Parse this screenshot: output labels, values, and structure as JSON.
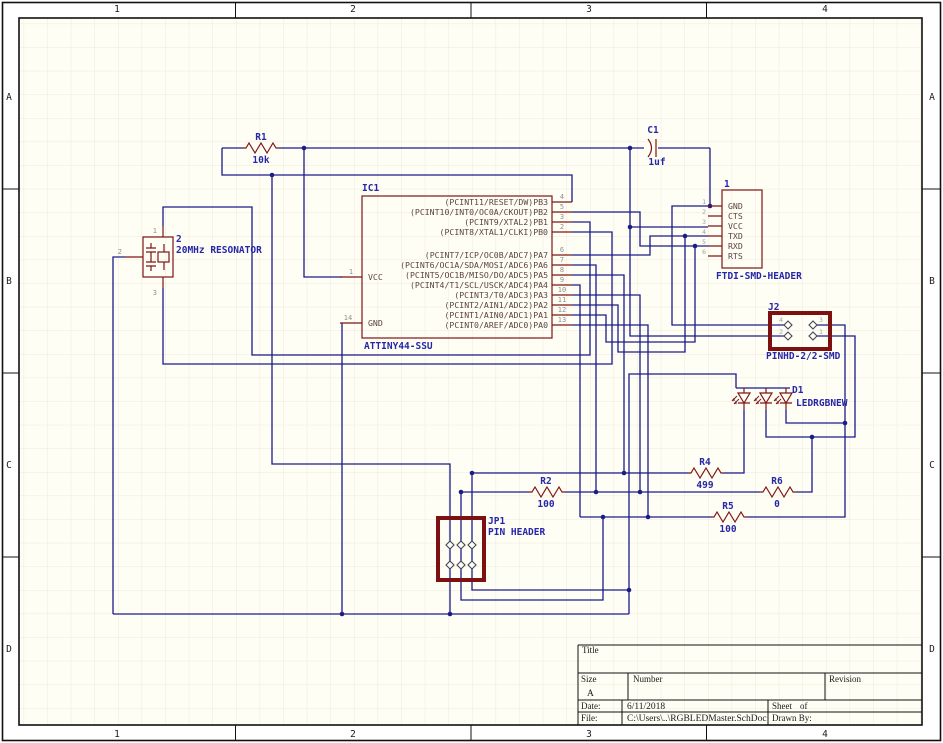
{
  "sheet": {
    "zone_columns": [
      "1",
      "2",
      "3",
      "4"
    ],
    "zone_rows": [
      "A",
      "B",
      "C",
      "D"
    ]
  },
  "title_block": {
    "title_label": "Title",
    "size_label": "Size",
    "size_value": "A",
    "number_label": "Number",
    "revision_label": "Revision",
    "date_label": "Date:",
    "date_value": "6/11/2018",
    "file_label": "File:",
    "file_value": "C:\\Users\\..\\RGBLEDMaster.SchDoc",
    "sheet_label": "Sheet",
    "sheet_of": "of",
    "drawn_by_label": "Drawn By:"
  },
  "components": {
    "ic1": {
      "designator": "IC1",
      "part": "ATTINY44-SSU",
      "left_pins": [
        {
          "num": "1",
          "name": "VCC"
        },
        {
          "num": "14",
          "name": "GND"
        }
      ],
      "right_pins": [
        {
          "num": "4",
          "name": "(PCINT11/RESET/DW)PB3"
        },
        {
          "num": "5",
          "name": "(PCINT10/INT0/OC0A/CKOUT)PB2"
        },
        {
          "num": "3",
          "name": "(PCINT9/XTAL2)PB1"
        },
        {
          "num": "2",
          "name": "(PCINT8/XTAL1/CLKI)PB0"
        },
        {
          "num": "6",
          "name": "(PCINT7/ICP/OC0B/ADC7)PA7"
        },
        {
          "num": "7",
          "name": "(PCINT6/OC1A/SDA/MOSI/ADC6)PA6"
        },
        {
          "num": "8",
          "name": "(PCINT5/OC1B/MISO/DO/ADC5)PA5"
        },
        {
          "num": "9",
          "name": "(PCINT4/T1/SCL/USCK/ADC4)PA4"
        },
        {
          "num": "10",
          "name": "(PCINT3/T0/ADC3)PA3"
        },
        {
          "num": "11",
          "name": "(PCINT2/AIN1/ADC2)PA2"
        },
        {
          "num": "12",
          "name": "(PCINT1/AIN0/ADC1)PA1"
        },
        {
          "num": "13",
          "name": "(PCINT0/AREF/ADC0)PA0"
        }
      ]
    },
    "resonator": {
      "designator": "2",
      "name": "20MHz RESONATOR",
      "pin_numbers": [
        "1",
        "2",
        "3"
      ]
    },
    "ftdi": {
      "designator": "1",
      "name": "FTDI-SMD-HEADER",
      "pins": [
        "GND",
        "CTS",
        "VCC",
        "TXD",
        "RXD",
        "RTS"
      ],
      "pin_numbers": [
        "1",
        "2",
        "3",
        "4",
        "5",
        "6"
      ]
    },
    "j2": {
      "designator": "J2",
      "name": "PINHD-2/2-SMD",
      "pin_numbers": [
        "4",
        "3",
        "2",
        "1"
      ]
    },
    "d1": {
      "designator": "D1",
      "name": "LEDRGBNEW"
    },
    "jp1": {
      "designator": "JP1",
      "name": "PIN HEADER"
    },
    "r1": {
      "designator": "R1",
      "value": "10k"
    },
    "r2": {
      "designator": "R2",
      "value": "100"
    },
    "r4": {
      "designator": "R4",
      "value": "499"
    },
    "r5": {
      "designator": "R5",
      "value": "100"
    },
    "r6": {
      "designator": "R6",
      "value": "0"
    },
    "c1": {
      "designator": "C1",
      "value": "1uf"
    }
  },
  "colors": {
    "wire": "#1b1b8a",
    "component_outline": "#7d1616",
    "label": "#2626a8",
    "pin_text": "#5c4343",
    "pin_number": "#8f8f8f",
    "sheet_bg": "#fffef5",
    "grid": "#ece9da"
  }
}
